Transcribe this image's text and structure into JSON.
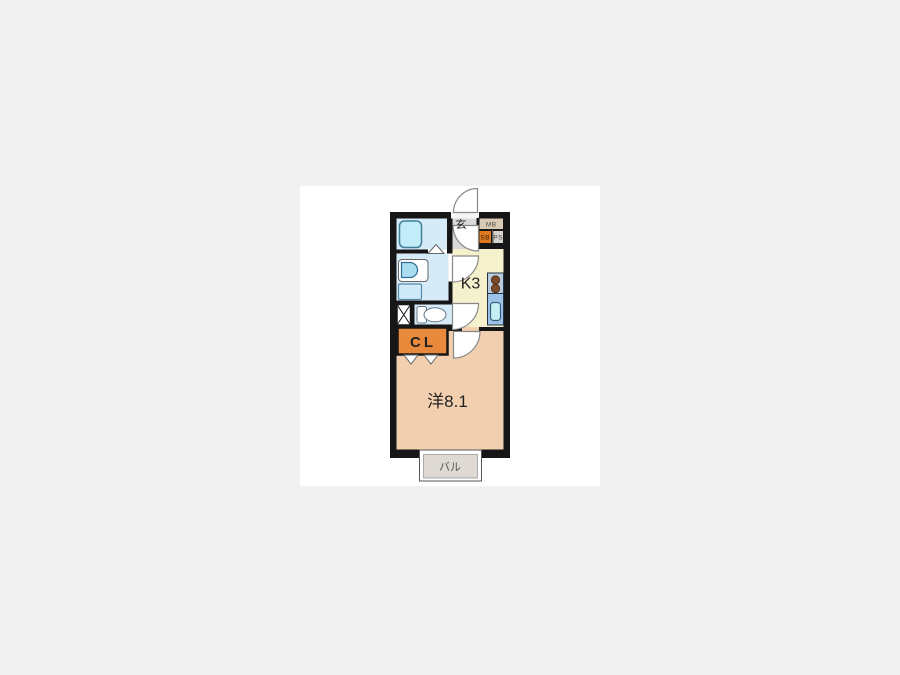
{
  "floorplan": {
    "title": "1K apartment floor plan",
    "rooms": {
      "entrance": {
        "label": "玄"
      },
      "kitchen": {
        "label": "K3"
      },
      "closet": {
        "label": "CL"
      },
      "western_room": {
        "label": "洋8.1"
      },
      "balcony": {
        "label": "バル"
      },
      "meter_box": {
        "label": "MB"
      },
      "shoe_box": {
        "label": "SB"
      },
      "pipe_space": {
        "label": "PS"
      }
    },
    "colors": {
      "page_background": "#f1f1f1",
      "canvas": "#ffffff",
      "wall": "#161616",
      "wet_area": "#d5ecf8",
      "kitchen": "#f6f1cd",
      "western_room": "#f2cfae",
      "closet": "#e8893c",
      "entrance_floor": "#d9d9d9",
      "meter_box_bg": "#d8cab4",
      "shoe_box_bg": "#e07820",
      "pipe_space_bg": "#d6d2ce",
      "balcony_bg": "#dedad3",
      "tub": "#c2ecf8",
      "sink_counter": "#9fc3e8",
      "stove_counter": "#b9cbdc",
      "burner": "#7b4a28",
      "fixture_white": "#ffffff"
    }
  }
}
